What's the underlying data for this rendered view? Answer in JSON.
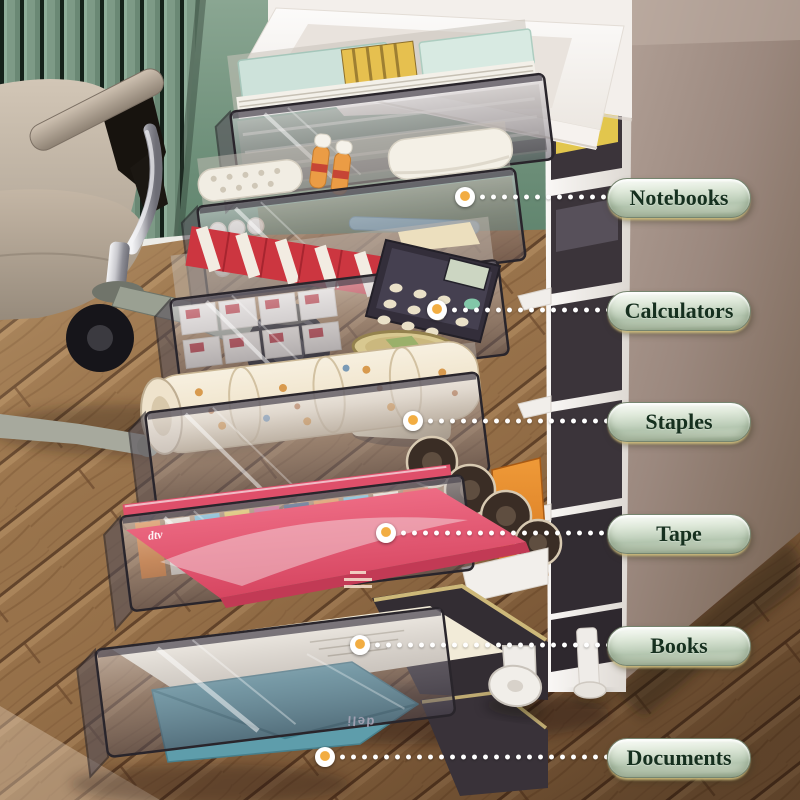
{
  "callouts": [
    {
      "label": "Notebooks",
      "dot": {
        "x": 465,
        "y": 197
      }
    },
    {
      "label": "Calculators",
      "dot": {
        "x": 437,
        "y": 310
      }
    },
    {
      "label": "Staples",
      "dot": {
        "x": 413,
        "y": 421
      }
    },
    {
      "label": "Tape",
      "dot": {
        "x": 386,
        "y": 533
      }
    },
    {
      "label": "Books",
      "dot": {
        "x": 360,
        "y": 645
      }
    },
    {
      "label": "Documents",
      "dot": {
        "x": 325,
        "y": 757
      }
    }
  ],
  "branding": {
    "drawer_side_logo": "deli",
    "magazine_logo": "dtv"
  },
  "palette": {
    "label_pill_light": "#f8fbf6",
    "label_pill_dark": "#a9bca4",
    "label_text": "#16301f",
    "leader_dot_core": "#f2ad42",
    "wall_green": "#6f927c",
    "wood_brown": "#96714a",
    "desk_taupe": "#9b887e",
    "cart_white": "#f4f1ed",
    "drawer_glass": "#6d6570"
  }
}
